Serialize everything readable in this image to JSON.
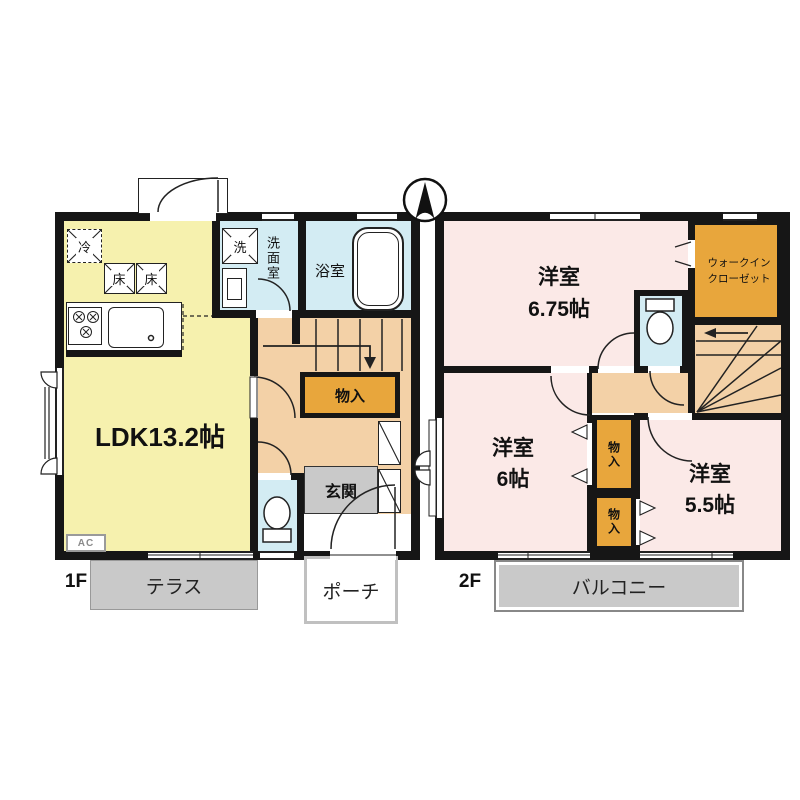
{
  "colors": {
    "wall": "#161616",
    "line": "#222222",
    "ldk": "#f6f1ae",
    "wet": "#d3ecf3",
    "hall": "#f3d1a7",
    "storage": "#e8a63c",
    "bedroom": "#fbe9e7",
    "outdoor_gray": "#c9c9c9"
  },
  "f1": {
    "floor_label": "1F",
    "ldk_label": "LDK13.2帖",
    "washroom_label": "洗面室",
    "bath_label": "浴室",
    "storage_label": "物入",
    "entrance_label": "玄関",
    "terrace_label": "テラス",
    "porch_label": "ポーチ",
    "ac_label": "AC",
    "fridge_label": "冷",
    "floor_hatch1": "床",
    "floor_hatch2": "床",
    "washer_label": "洗"
  },
  "f2": {
    "floor_label": "2F",
    "bedroom1_line1": "洋室",
    "bedroom1_line2": "6.75帖",
    "wic_line1": "ウォークイン",
    "wic_line2": "クローゼット",
    "bedroom2_line1": "洋室",
    "bedroom2_line2": "6帖",
    "bedroom3_line1": "洋室",
    "bedroom3_line2": "5.5帖",
    "closet1_label": "物入",
    "closet2_label": "物入",
    "balcony_label": "バルコニー"
  }
}
